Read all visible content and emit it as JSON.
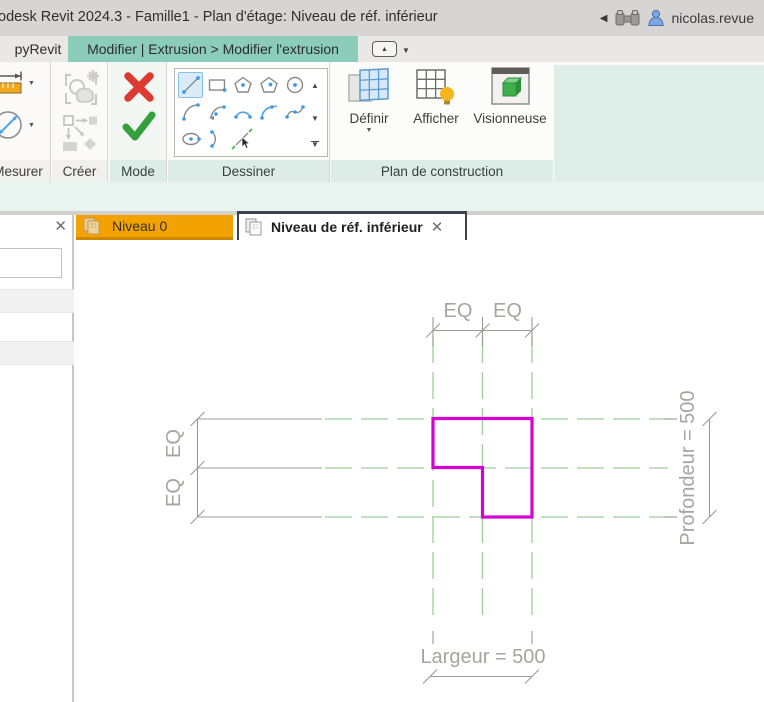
{
  "title_bar": {
    "title": "odesk Revit 2024.3 - Famille1 - Plan d'étage: Niveau de réf. inférieur",
    "user": "nicolas.revue"
  },
  "tab_strip": {
    "pyrevit_tab": "pyRevit",
    "contextual_tab": "Modifier | Extrusion > Modifier l'extrusion"
  },
  "ribbon": {
    "panel_mesurer": "Mesurer",
    "panel_creer": "Créer",
    "panel_mode": "Mode",
    "panel_dessiner": "Dessiner",
    "panel_plan": "Plan de construction",
    "definir": "Définir",
    "afficher": "Afficher",
    "visionneuse": "Visionneuse"
  },
  "view_tabs": {
    "tab1": "Niveau 0",
    "tab2": "Niveau de réf. inférieur"
  },
  "canvas": {
    "eq_top_1": "EQ",
    "eq_top_2": "EQ",
    "eq_left_1": "EQ",
    "eq_left_2": "EQ",
    "dim_right": "Profondeur = 500",
    "dim_bottom": "Largeur = 500"
  },
  "icons": {
    "close": "✕",
    "dropdown": "▼",
    "up": "▲",
    "back": "◀"
  },
  "colors": {
    "contextual_teal": "#8ccdb9",
    "contextual_green": "#86bf40",
    "tab_orange": "#f2a202",
    "sketch_magenta": "#d400d4",
    "ref_plane_green": "#9ecf97",
    "dim_gray": "#9b9b97"
  }
}
